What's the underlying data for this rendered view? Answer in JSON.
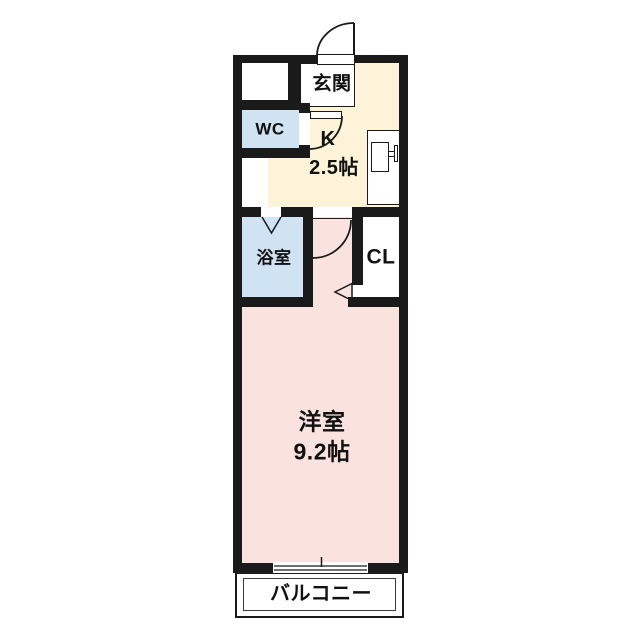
{
  "floorplan": {
    "labels": {
      "entrance": "玄関",
      "wc": "WC",
      "kitchen_name": "K",
      "kitchen_size": "2.5帖",
      "bathroom": "浴室",
      "closet": "CL",
      "room_name": "洋室",
      "room_size": "9.2帖",
      "balcony": "バルコニー"
    },
    "colors": {
      "wall": "#1a1a1a",
      "kitchen": "#fcf3d8",
      "water": "#cfe3f2",
      "room": "#fae3df",
      "white": "#ffffff"
    },
    "symbols": [
      "swing-door",
      "folding-door",
      "sliding-door-arrow",
      "sliding-window",
      "kitchen-sink"
    ]
  }
}
